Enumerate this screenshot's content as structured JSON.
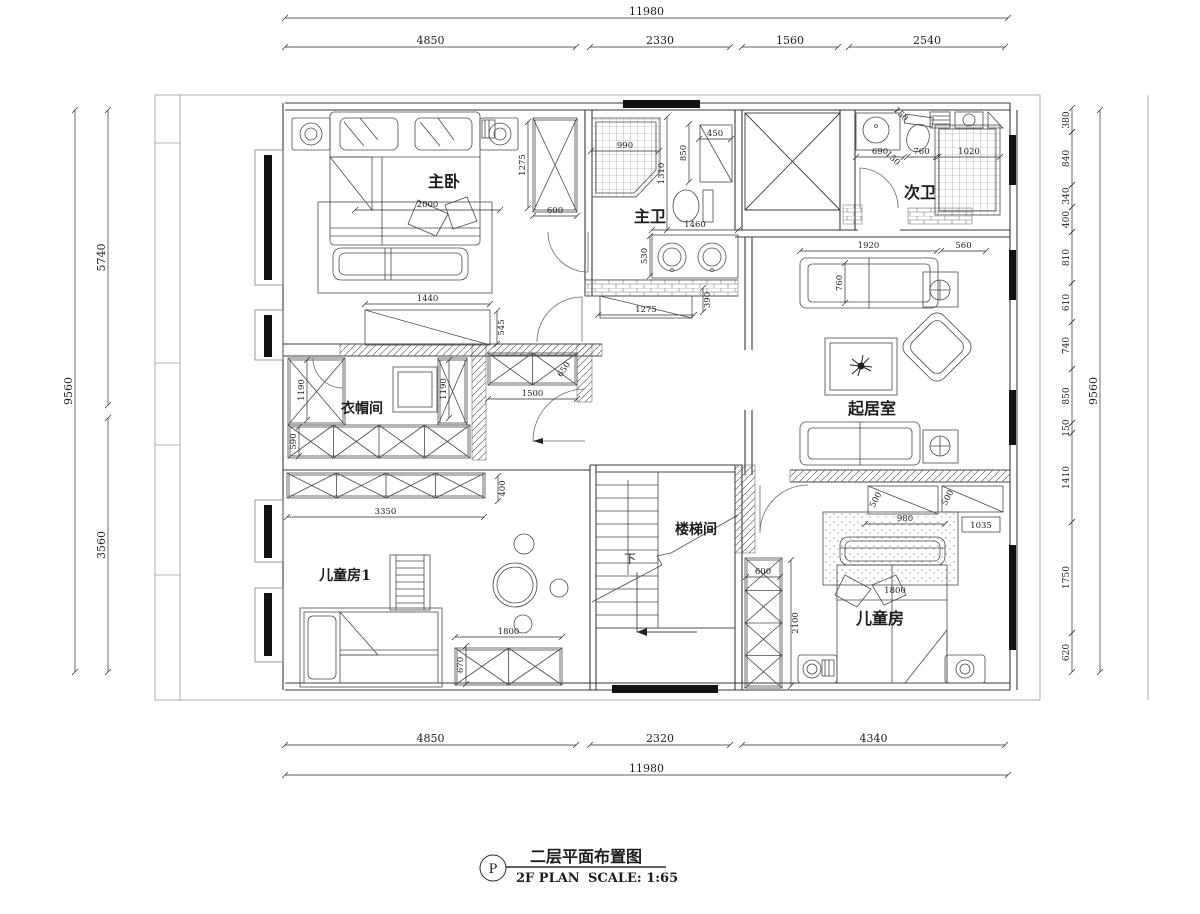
{
  "title_block": {
    "symbol": "P",
    "title_cn": "二层平面布置图",
    "title_en": "2F PLAN",
    "scale": "SCALE: 1:65"
  },
  "rooms": {
    "master_bedroom": "主卧",
    "master_bath": "主卫",
    "second_bath": "次卫",
    "closet": "衣帽间",
    "living_room": "起居室",
    "stairwell": "楼梯间",
    "kids_room_1": "儿童房1",
    "kids_room_2": "儿童房",
    "stairs_down": "下"
  },
  "dimensions": {
    "top": {
      "total": "11980",
      "segments": [
        "4850",
        "2330",
        "1560",
        "2540"
      ]
    },
    "bottom": {
      "total": "11980",
      "segments": [
        "4850",
        "2320",
        "4340"
      ]
    },
    "left": {
      "total": "9560",
      "segments": [
        "5740",
        "3560"
      ]
    },
    "right": {
      "total": "9560",
      "segments": [
        "380",
        "840",
        "340",
        "400",
        "810",
        "610",
        "740",
        "850",
        "150",
        "1410",
        "1750",
        "620"
      ]
    },
    "interior": {
      "bed_master": "2000",
      "tv_width": "1440",
      "tv_depth": "545",
      "mb_wardrobe_h": "1275",
      "mb_wardrobe_w": "600",
      "shower1": "990",
      "bath1_len": "1310",
      "bath1_cab_h": "850",
      "bath1_cab_w": "450",
      "vanity_w": "1460",
      "vanity_d": "530",
      "hall_cab_w": "1275",
      "hall_cab_d": "390",
      "bath2_sink": "690",
      "bath2_toilet": "760",
      "bath2_shower": "1020",
      "bath2_gap1": "150",
      "bath2_gap2": "150",
      "sofa_w": "1920",
      "sofa_side": "560",
      "sofa_d": "760",
      "closet_left": "1190",
      "closet_right": "1190",
      "closet_bottom": "590",
      "hall_cabinet_w": "1500",
      "hall_cabinet_d": "650",
      "closet_row_w": "3350",
      "closet_row_d": "400",
      "kids1_cab_w": "1800",
      "kids1_cab_d": "670",
      "stair_closet_w": "600",
      "stair_closet_h": "2100",
      "kids2_cab1": "500",
      "kids2_cab2": "500",
      "kids2_shelf": "1035",
      "kids2_bench": "980",
      "kids2_bed": "1800"
    }
  }
}
